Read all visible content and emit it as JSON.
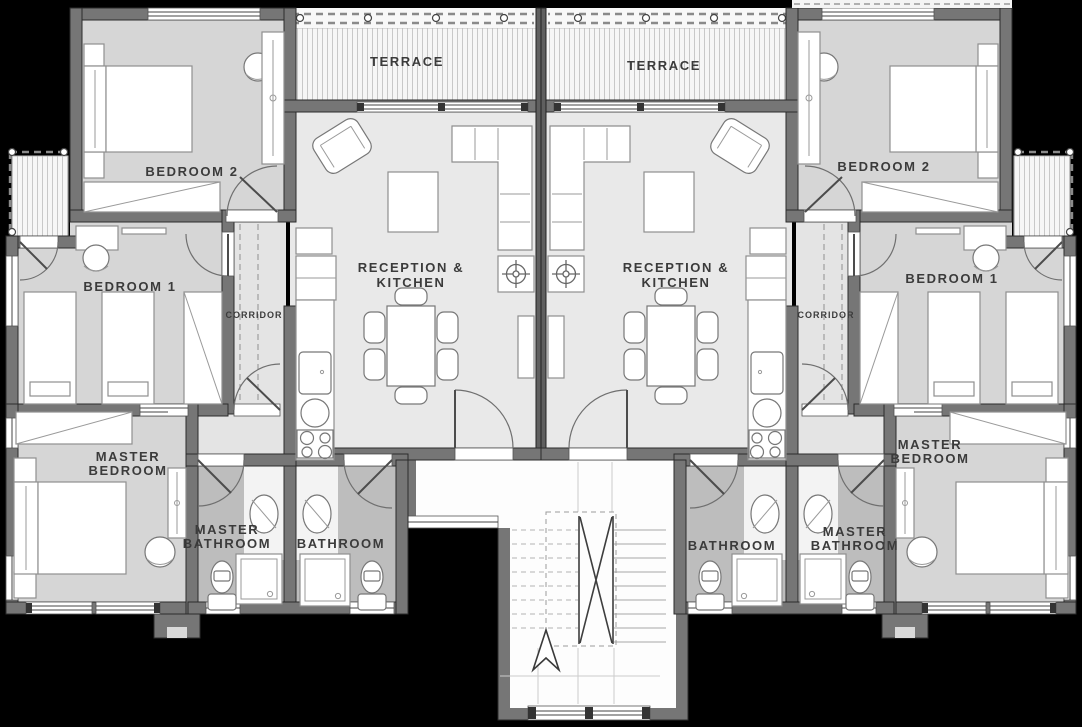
{
  "document": {
    "type": "architectural-floor-plan",
    "description": "Mirrored two-apartment residential floor plan with central stairwell"
  },
  "colors": {
    "background": "#000000",
    "wall": "#767676",
    "wall_outline": "#2c2c2c",
    "floor_bedroom": "#d6d6d6",
    "floor_reception": "#e9e9e9",
    "floor_bathroom": "#bdbdbd",
    "terrace_deck": "#f6f6f6",
    "label_text": "#3b3b3b",
    "furniture": "#ffffff"
  },
  "icons": {
    "north_arrow": "north-arrow",
    "ceiling_fan": "ceiling-fan-symbol"
  },
  "units": [
    {
      "id": "left-apartment",
      "labels": {
        "terrace": "TERRACE",
        "bedroom2": "BEDROOM 2",
        "bedroom1": "BEDROOM 1",
        "corridor": "CORRIDOR",
        "reception_line1": "RECEPTION &",
        "reception_line2": "KITCHEN",
        "master_bedroom_line1": "MASTER",
        "master_bedroom_line2": "BEDROOM",
        "master_bathroom_line1": "MASTER",
        "master_bathroom_line2": "BATHROOM",
        "bathroom": "BATHROOM"
      }
    },
    {
      "id": "right-apartment",
      "labels": {
        "terrace": "TERRACE",
        "bedroom2": "BEDROOM 2",
        "bedroom1": "BEDROOM 1",
        "corridor": "CORRIDOR",
        "reception_line1": "RECEPTION &",
        "reception_line2": "KITCHEN",
        "master_bedroom_line1": "MASTER",
        "master_bedroom_line2": "BEDROOM",
        "master_bathroom_line1": "MASTER",
        "master_bathroom_line2": "BATHROOM",
        "bathroom": "BATHROOM"
      }
    }
  ]
}
